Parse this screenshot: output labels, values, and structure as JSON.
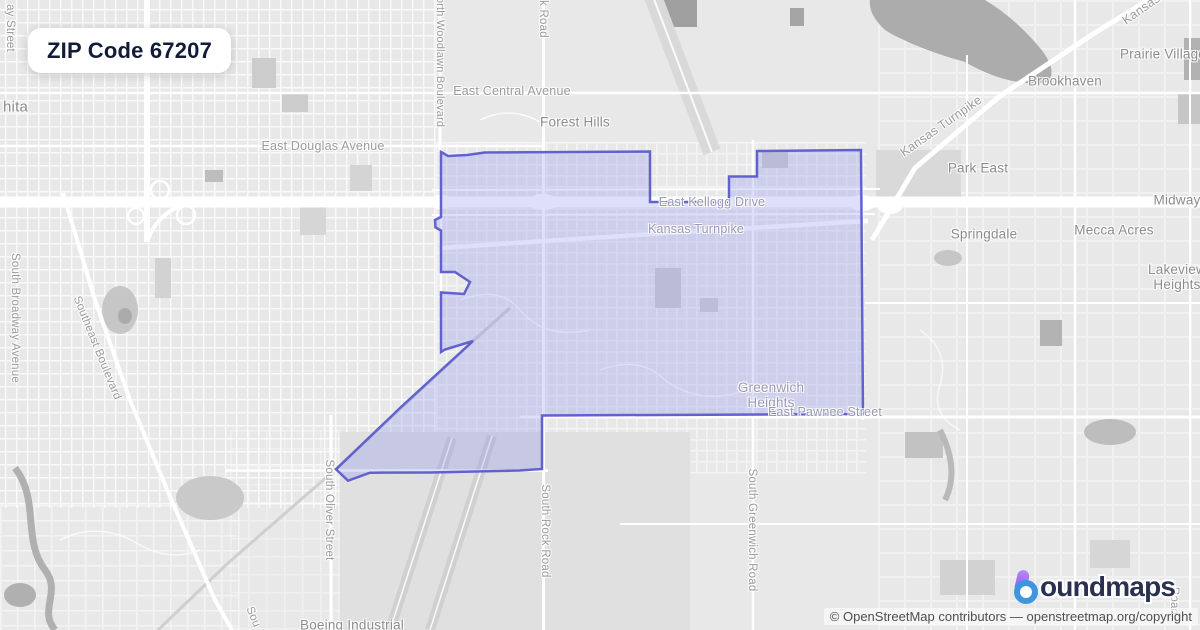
{
  "badge": {
    "title": "ZIP Code 67207"
  },
  "map_labels": {
    "wichita_fragment": "hita",
    "ay_street_fragment": "ay Street",
    "south_broadway": "South Broadway Avenue",
    "southeast_blvd": "Southeast Boulevard",
    "east_douglas": "East Douglas Avenue",
    "east_central": "East Central Avenue",
    "forest_hills": "Forest Hills",
    "north_woodlawn_fragment": "orth Woodlawn Boulevard",
    "rock_road_top_fragment": "k Road",
    "east_kellogg": "East Kellogg Drive",
    "kansas_turnpike_inner": "Kansas Turnpike",
    "kansas_turnpike_ne": "Kansas Turnpike",
    "kansas_turnpike_corner": "Kansas Turnpike",
    "prairie_village": "Prairie Village",
    "brookhaven": "Brookhaven",
    "park_east": "Park East",
    "midway": "Midway",
    "springdale": "Springdale",
    "mecca_acres": "Mecca Acres",
    "lakeview_heights": "Lakeview Heights",
    "greenwich_heights": "Greenwich Heights",
    "east_pawnee": "East Pawnee Street",
    "south_oliver": "South Oliver Street",
    "south_rock": "South Rock Road",
    "south_greenwich": "South Greenwich Road",
    "boeing_industrial": "Boeing Industrial",
    "sou_fragment": "Sou",
    "road_fragment": "Road"
  },
  "logo": {
    "icon": "boundmaps-b-icon",
    "text": "oundmaps"
  },
  "attribution": "© OpenStreetMap contributors — openstreetmap.org/copyright",
  "colors": {
    "land": "#e8e8e8",
    "boundary_stroke": "#6262cf",
    "boundary_fill": "rgba(124,128,234,0.25)",
    "badge_text": "#131c36",
    "logo_text": "#2a3150",
    "logo_purple": "#9a63f2",
    "logo_blue": "#3e96de"
  }
}
